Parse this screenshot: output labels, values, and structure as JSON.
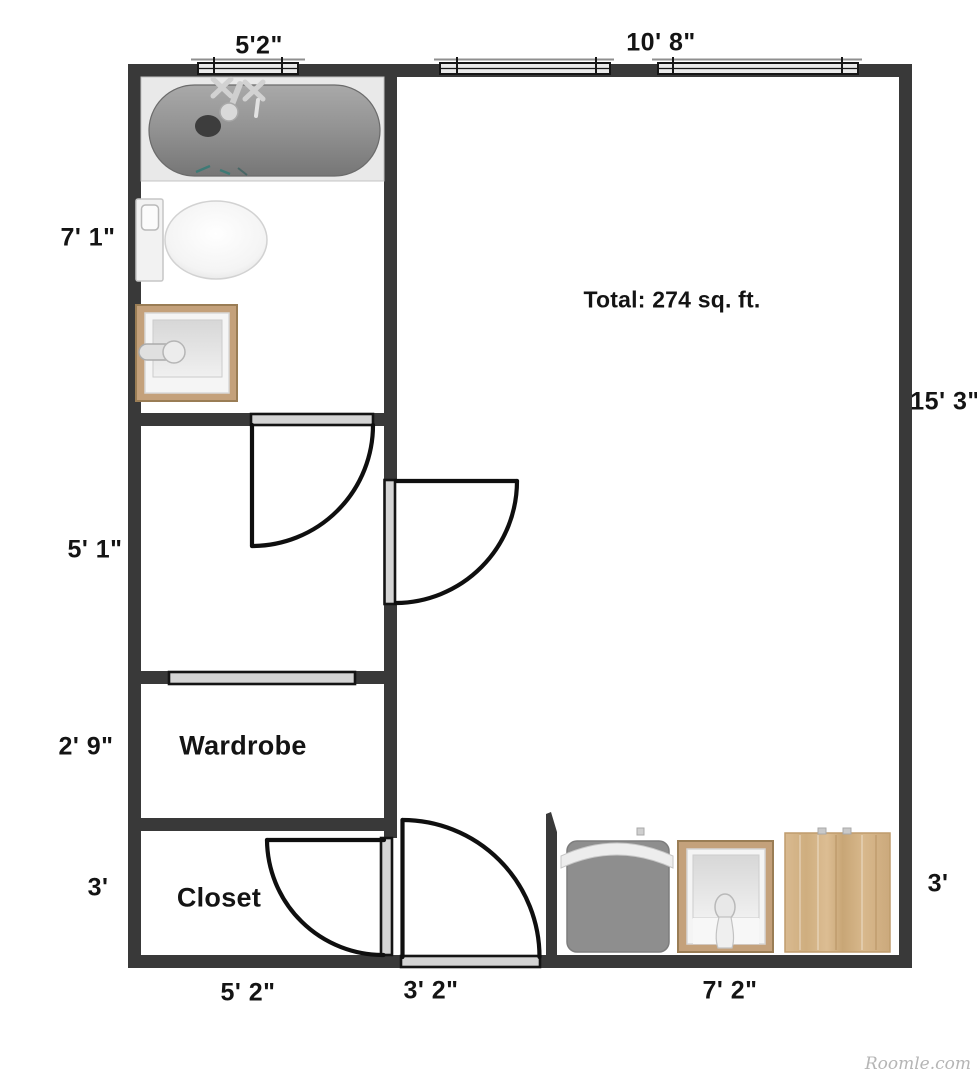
{
  "plan": {
    "total_label": "Total: 274 sq. ft.",
    "watermark": "Roomle.com",
    "rooms": {
      "wardrobe": "Wardrobe",
      "closet": "Closet"
    },
    "dimensions": {
      "top_bathroom_window": "5'2\"",
      "top_main": "10' 8\"",
      "left_bathroom": "7' 1\"",
      "left_hall": "5' 1\"",
      "left_wardrobe": "2' 9\"",
      "left_closet": "3'",
      "right_main": "15' 3\"",
      "right_kitchen": "3'",
      "bottom_closet": "5' 2\"",
      "bottom_entry": "3' 2\"",
      "bottom_kitchen": "7' 2\""
    },
    "colors": {
      "wall": "#393939",
      "door_panel": "#d4d4d4",
      "window_fill": "#eaeaea",
      "wood": "#c4a17b",
      "tub": "#8f8f8f",
      "label_text": "#141414",
      "watermark_text": "#b5b5b5"
    }
  }
}
